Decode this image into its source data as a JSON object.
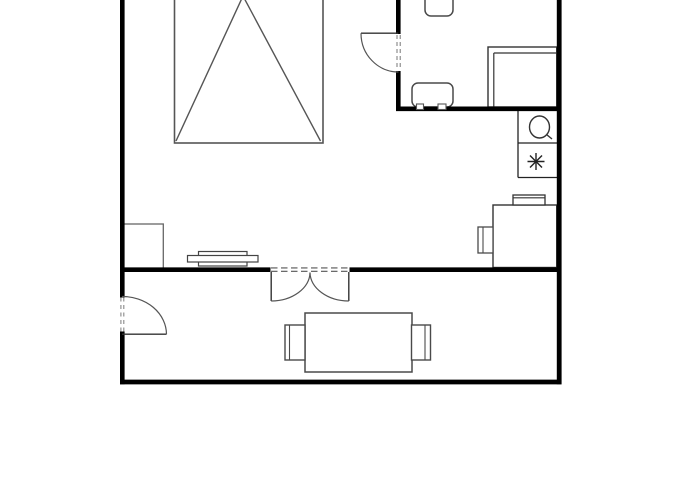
{
  "canvas": {
    "width": 700,
    "height": 500,
    "background": "#ffffff"
  },
  "palette": {
    "wall_color": "#000000",
    "furniture_dark": "#333333",
    "furniture_gray": "#4a4a4a",
    "bed_gray": "#555555",
    "light_gray": "#888888",
    "fill_white": "#ffffff"
  },
  "floorplan": {
    "layers": [
      {
        "name": "furniture-layer",
        "items": [
          {
            "name": "bed",
            "shapes": [
              {
                "kind": "rect",
                "x": 174.5,
                "y": -8,
                "w": 148.5,
                "h": 151,
                "stroke": "#555555",
                "sw": 1.6,
                "fill": "#ffffff"
              },
              {
                "kind": "line",
                "x1": 243,
                "y1": -4,
                "x2": 176,
                "y2": 141,
                "stroke": "#555555",
                "sw": 1.4
              },
              {
                "kind": "line",
                "x1": 243,
                "y1": -4,
                "x2": 320.5,
                "y2": 141,
                "stroke": "#555555",
                "sw": 1.4
              }
            ]
          },
          {
            "name": "wardrobe",
            "shapes": [
              {
                "kind": "rect",
                "x": 122.5,
                "y": 224,
                "w": 40.8,
                "h": 44.5,
                "stroke": "#666666",
                "sw": 1.3,
                "fill": "#ffffff"
              }
            ]
          },
          {
            "name": "wall-shelf",
            "shapes": [
              {
                "kind": "rect",
                "x": 198.5,
                "y": 251.5,
                "w": 48.5,
                "h": 5,
                "stroke": "#444444",
                "sw": 1.2,
                "fill": "#ffffff"
              },
              {
                "kind": "rect",
                "x": 198.5,
                "y": 261.5,
                "w": 48.5,
                "h": 4.5,
                "stroke": "#444444",
                "sw": 1.2,
                "fill": "#ffffff"
              },
              {
                "kind": "rect",
                "x": 187.5,
                "y": 255.5,
                "w": 70.5,
                "h": 6.5,
                "stroke": "#444444",
                "sw": 1.2,
                "fill": "#ffffff"
              }
            ]
          },
          {
            "name": "fixture-divider",
            "shapes": [
              {
                "kind": "line",
                "x1": 518,
                "y1": 111,
                "x2": 518,
                "y2": 177.5,
                "stroke": "#222222",
                "sw": 1.3
              },
              {
                "kind": "line",
                "x1": 518,
                "y1": 143,
                "x2": 557,
                "y2": 143,
                "stroke": "#222222",
                "sw": 1.3
              },
              {
                "kind": "line",
                "x1": 518,
                "y1": 177.5,
                "x2": 557,
                "y2": 177.5,
                "stroke": "#222222",
                "sw": 1.3
              }
            ]
          },
          {
            "name": "sink-fixture",
            "shapes": [
              {
                "kind": "ellipse",
                "cx": 539.5,
                "cy": 127,
                "rx": 10,
                "ry": 11,
                "stroke": "#333333",
                "sw": 1.4,
                "fill": "#ffffff"
              },
              {
                "kind": "line",
                "x1": 546.5,
                "y1": 134.5,
                "x2": 552,
                "y2": 139,
                "stroke": "#333333",
                "sw": 1.4
              }
            ]
          },
          {
            "name": "star-fixture-icon",
            "shapes": [
              {
                "kind": "line",
                "x1": 527.5,
                "y1": 161.5,
                "x2": 544.5,
                "y2": 161.5,
                "stroke": "#222222",
                "sw": 1.4
              },
              {
                "kind": "line",
                "x1": 536,
                "y1": 153,
                "x2": 536,
                "y2": 170,
                "stroke": "#222222",
                "sw": 1.4
              },
              {
                "kind": "line",
                "x1": 530,
                "y1": 155.5,
                "x2": 542,
                "y2": 167.5,
                "stroke": "#222222",
                "sw": 1.4
              },
              {
                "kind": "line",
                "x1": 530,
                "y1": 167.5,
                "x2": 542,
                "y2": 155.5,
                "stroke": "#222222",
                "sw": 1.4
              }
            ]
          },
          {
            "name": "office-chair-top",
            "shapes": [
              {
                "kind": "rect",
                "x": 425,
                "y": -10,
                "w": 28,
                "h": 26,
                "rx": 6,
                "stroke": "#4a4a4a",
                "sw": 1.5,
                "fill": "#ffffff"
              }
            ]
          },
          {
            "name": "office-chair-side",
            "shapes": [
              {
                "kind": "rect",
                "x": 412,
                "y": 83,
                "w": 41,
                "h": 24,
                "rx": 6,
                "stroke": "#4a4a4a",
                "sw": 1.5,
                "fill": "#ffffff"
              }
            ]
          },
          {
            "name": "office-desk",
            "shapes": [
              {
                "kind": "rect",
                "x": 488,
                "y": 47,
                "w": 68.7,
                "h": 60,
                "stroke": "#333333",
                "sw": 1.4,
                "fill": "#ffffff"
              },
              {
                "kind": "line",
                "x1": 493.8,
                "y1": 53,
                "x2": 556.7,
                "y2": 53,
                "stroke": "#333333",
                "sw": 1.2
              },
              {
                "kind": "line",
                "x1": 493.8,
                "y1": 53,
                "x2": 493.8,
                "y2": 107,
                "stroke": "#333333",
                "sw": 1.2
              }
            ]
          },
          {
            "name": "study-desk",
            "shapes": [
              {
                "kind": "rect",
                "x": 493,
                "y": 205,
                "w": 63.7,
                "h": 62.5,
                "stroke": "#333333",
                "sw": 1.4,
                "fill": "#ffffff"
              }
            ]
          },
          {
            "name": "desk-monitor",
            "shapes": [
              {
                "kind": "rect",
                "x": 513,
                "y": 195,
                "w": 32,
                "h": 10,
                "stroke": "#333333",
                "sw": 1.3,
                "fill": "#ffffff"
              },
              {
                "kind": "line",
                "x1": 513,
                "y1": 197.8,
                "x2": 545,
                "y2": 197.8,
                "stroke": "#333333",
                "sw": 1.1
              }
            ]
          },
          {
            "name": "desk-chair",
            "shapes": [
              {
                "kind": "rect",
                "x": 478,
                "y": 227,
                "w": 15,
                "h": 26,
                "stroke": "#4a4a4a",
                "sw": 1.3,
                "fill": "#ffffff"
              },
              {
                "kind": "line",
                "x1": 483,
                "y1": 227,
                "x2": 483,
                "y2": 253,
                "stroke": "#4a4a4a",
                "sw": 1.1
              }
            ]
          },
          {
            "name": "dining-table",
            "shapes": [
              {
                "kind": "rect",
                "x": 305,
                "y": 313,
                "w": 107,
                "h": 59,
                "stroke": "#4a4a4a",
                "sw": 1.5,
                "fill": "#ffffff"
              }
            ]
          },
          {
            "name": "dining-chair-left",
            "shapes": [
              {
                "kind": "rect",
                "x": 285,
                "y": 325,
                "w": 20,
                "h": 35,
                "stroke": "#4a4a4a",
                "sw": 1.4,
                "fill": "#ffffff"
              },
              {
                "kind": "line",
                "x1": 289.5,
                "y1": 325,
                "x2": 289.5,
                "y2": 360,
                "stroke": "#4a4a4a",
                "sw": 1.1
              }
            ]
          },
          {
            "name": "dining-chair-right",
            "shapes": [
              {
                "kind": "rect",
                "x": 411.5,
                "y": 325,
                "w": 19,
                "h": 35,
                "stroke": "#4a4a4a",
                "sw": 1.4,
                "fill": "#ffffff"
              },
              {
                "kind": "line",
                "x1": 425,
                "y1": 325,
                "x2": 425,
                "y2": 360,
                "stroke": "#4a4a4a",
                "sw": 1.1
              }
            ]
          }
        ]
      },
      {
        "name": "walls-layer",
        "items": [
          {
            "name": "wall-left-upper",
            "shapes": [
              {
                "kind": "line",
                "x1": 122.3,
                "y1": 0,
                "x2": 122.3,
                "y2": 297.5,
                "stroke": "#000000",
                "sw": 4.6
              }
            ]
          },
          {
            "name": "wall-left-lower",
            "shapes": [
              {
                "kind": "line",
                "x1": 122.3,
                "y1": 331.5,
                "x2": 122.3,
                "y2": 384.3,
                "stroke": "#000000",
                "sw": 4.6
              }
            ]
          },
          {
            "name": "wall-bottom",
            "shapes": [
              {
                "kind": "line",
                "x1": 120,
                "y1": 382,
                "x2": 561.5,
                "y2": 382,
                "stroke": "#000000",
                "sw": 4.8
              }
            ]
          },
          {
            "name": "wall-right",
            "shapes": [
              {
                "kind": "line",
                "x1": 559.2,
                "y1": 0,
                "x2": 559.2,
                "y2": 384.3,
                "stroke": "#000000",
                "sw": 4.8
              }
            ]
          },
          {
            "name": "wall-middle-left",
            "shapes": [
              {
                "kind": "line",
                "x1": 120,
                "y1": 269.7,
                "x2": 270.5,
                "y2": 269.7,
                "stroke": "#000000",
                "sw": 4.6
              }
            ]
          },
          {
            "name": "wall-middle-right",
            "shapes": [
              {
                "kind": "line",
                "x1": 349.5,
                "y1": 269.7,
                "x2": 561.5,
                "y2": 269.7,
                "stroke": "#000000",
                "sw": 4.6
              }
            ]
          },
          {
            "name": "wall-office-left-upper",
            "shapes": [
              {
                "kind": "line",
                "x1": 398.3,
                "y1": 0,
                "x2": 398.3,
                "y2": 34,
                "stroke": "#000000",
                "sw": 4.6
              }
            ]
          },
          {
            "name": "wall-office-left-lower",
            "shapes": [
              {
                "kind": "line",
                "x1": 398.3,
                "y1": 71,
                "x2": 398.3,
                "y2": 111,
                "stroke": "#000000",
                "sw": 4.6
              }
            ]
          },
          {
            "name": "wall-office-bottom",
            "shapes": [
              {
                "kind": "line",
                "x1": 396,
                "y1": 108.8,
                "x2": 561.5,
                "y2": 108.8,
                "stroke": "#000000",
                "sw": 4.6
              }
            ]
          }
        ]
      },
      {
        "name": "openings-layer",
        "items": [
          {
            "name": "office-door",
            "shapes": [
              {
                "kind": "line",
                "x1": 397,
                "y1": 35,
                "x2": 397,
                "y2": 70,
                "stroke": "#777777",
                "sw": 1,
                "dash": "4,3"
              },
              {
                "kind": "line",
                "x1": 400.2,
                "y1": 35,
                "x2": 400.2,
                "y2": 70,
                "stroke": "#777777",
                "sw": 1,
                "dash": "4,3"
              },
              {
                "kind": "line",
                "x1": 361,
                "y1": 33.2,
                "x2": 398.3,
                "y2": 33.2,
                "stroke": "#333333",
                "sw": 1.3
              },
              {
                "kind": "path",
                "d": "M 361 33.2 A 37.5 38.8 0 0 0 398.5 72",
                "stroke": "#555555",
                "sw": 1.2,
                "fill": "none"
              }
            ]
          },
          {
            "name": "entry-door",
            "shapes": [
              {
                "kind": "line",
                "x1": 120.9,
                "y1": 297.5,
                "x2": 120.9,
                "y2": 331.5,
                "stroke": "#888888",
                "sw": 1.1,
                "dash": "4,3.5"
              },
              {
                "kind": "line",
                "x1": 123.8,
                "y1": 297.5,
                "x2": 123.8,
                "y2": 331.5,
                "stroke": "#888888",
                "sw": 1.1,
                "dash": "4,3.5"
              },
              {
                "kind": "line",
                "x1": 122,
                "y1": 334.2,
                "x2": 166.5,
                "y2": 334.2,
                "stroke": "#333333",
                "sw": 1.4
              },
              {
                "kind": "path",
                "d": "M 122 296.5 A 44 38 0 0 1 166.5 334.2",
                "stroke": "#555555",
                "sw": 1.2,
                "fill": "none"
              }
            ]
          },
          {
            "name": "double-door",
            "shapes": [
              {
                "kind": "line",
                "x1": 271,
                "y1": 267.9,
                "x2": 349,
                "y2": 267.9,
                "stroke": "#555555",
                "sw": 1.1,
                "dash": "6.5,3.5"
              },
              {
                "kind": "line",
                "x1": 271,
                "y1": 271.3,
                "x2": 349,
                "y2": 271.3,
                "stroke": "#555555",
                "sw": 1.1,
                "dash": "6.5,3.5"
              },
              {
                "kind": "line",
                "x1": 271.2,
                "y1": 272,
                "x2": 271.2,
                "y2": 301,
                "stroke": "#333333",
                "sw": 1.4
              },
              {
                "kind": "line",
                "x1": 348.8,
                "y1": 272,
                "x2": 348.8,
                "y2": 301,
                "stroke": "#333333",
                "sw": 1.4
              },
              {
                "kind": "path",
                "d": "M 271.2 301 A 39 29 0 0 0 310 272.5",
                "stroke": "#555555",
                "sw": 1.2,
                "fill": "none"
              },
              {
                "kind": "path",
                "d": "M 348.8 301 A 39 29 0 0 1 310 272.5",
                "stroke": "#555555",
                "sw": 1.2,
                "fill": "none"
              }
            ]
          },
          {
            "name": "office-chair-side-feet",
            "shapes": [
              {
                "kind": "rect",
                "x": 416.5,
                "y": 104,
                "w": 7,
                "h": 5.5,
                "stroke": "#555555",
                "sw": 1.1,
                "fill": "#ffffff"
              },
              {
                "kind": "rect",
                "x": 438,
                "y": 104,
                "w": 8,
                "h": 5.5,
                "stroke": "#555555",
                "sw": 1.1,
                "fill": "#ffffff"
              }
            ]
          }
        ]
      }
    ]
  }
}
